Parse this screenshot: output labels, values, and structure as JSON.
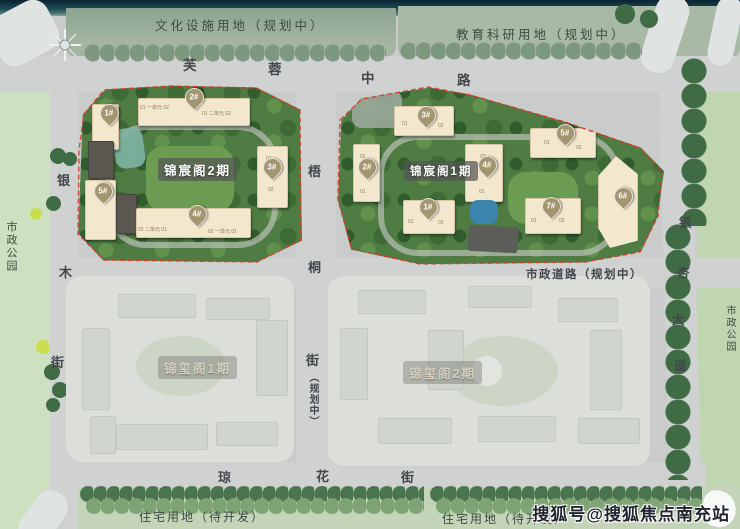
{
  "zones": {
    "cultural": "文化设施用地（规划中）",
    "education": "教育科研用地（规划中）",
    "park_left": "市政公园",
    "park_right": "市政公园",
    "resi_left": "住宅用地（待开发）",
    "resi_right": "住宅用地（待开发）"
  },
  "roads": {
    "furong": [
      "芙",
      "蓉",
      "中",
      "路"
    ],
    "yinmu": [
      "银",
      "木",
      "街"
    ],
    "yinxing": [
      "银",
      "杏",
      "大",
      "道"
    ],
    "wutong": [
      "梧",
      "桐",
      "街"
    ],
    "wutong_suffix": "（规划中）",
    "qionghua": [
      "琼",
      "花",
      "街"
    ],
    "shizheng": "市政道路（规划中）"
  },
  "phases": {
    "jc2": {
      "name": "锦宸阁2期",
      "pins": [
        "1#",
        "2#",
        "3#",
        "4#",
        "5#"
      ],
      "units": [
        "01 一单元 02",
        "01 二单元 02",
        "02 二单元 01",
        "02 一单元 01",
        "01",
        "02"
      ]
    },
    "jc1": {
      "name": "锦宸阁1期",
      "pins": [
        "1#",
        "2#",
        "3#",
        "4#",
        "5#",
        "6#",
        "7#"
      ],
      "units": [
        "01",
        "02",
        "01",
        "02",
        "02",
        "01",
        "02",
        "01",
        "01",
        "02",
        "01",
        "02"
      ]
    },
    "jx1": {
      "name": "锦玺阁1期"
    },
    "jx2": {
      "name": "锦玺阁2期"
    }
  },
  "watermark": "搜狐号@搜狐焦点南充站",
  "colors": {
    "boundary": "#d93a28",
    "building": "#f3e7cd",
    "block_green": "#4e7c42",
    "pin": "#a3956f"
  }
}
